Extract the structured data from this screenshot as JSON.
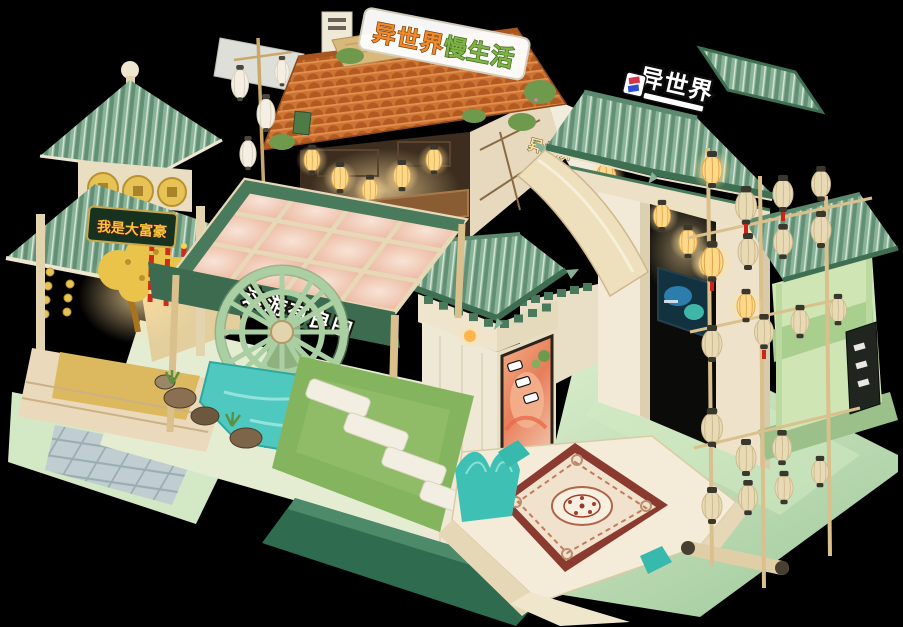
{
  "signs": {
    "tavern_roof": {
      "part1": "异世界",
      "part2": "慢生活"
    },
    "gate_roof": {
      "text": "异世界"
    },
    "wall": {
      "text": "异世界"
    },
    "pagoda": {
      "text": "我是大富豪"
    },
    "canopy_banner": {
      "text": "这游有良田"
    }
  },
  "colors": {
    "background": "#000000",
    "roof_green": "#87b297",
    "roof_green_dark": "#3f6f52",
    "roof_tile_orange": "#c96f33",
    "wood_cream": "#e8dcc0",
    "floor_green": "#cfe6c0",
    "water_teal": "#4fc9c0",
    "grass_green": "#85b45e",
    "carpet_border_red": "#8a3a2e",
    "carpet_cream": "#f0e2cc",
    "lantern_cream": "#e9dab6",
    "lantern_lit": "#ffd98a",
    "gold": "#e6c050",
    "sign_orange": "#f08a2a",
    "sign_green": "#7fb347"
  }
}
